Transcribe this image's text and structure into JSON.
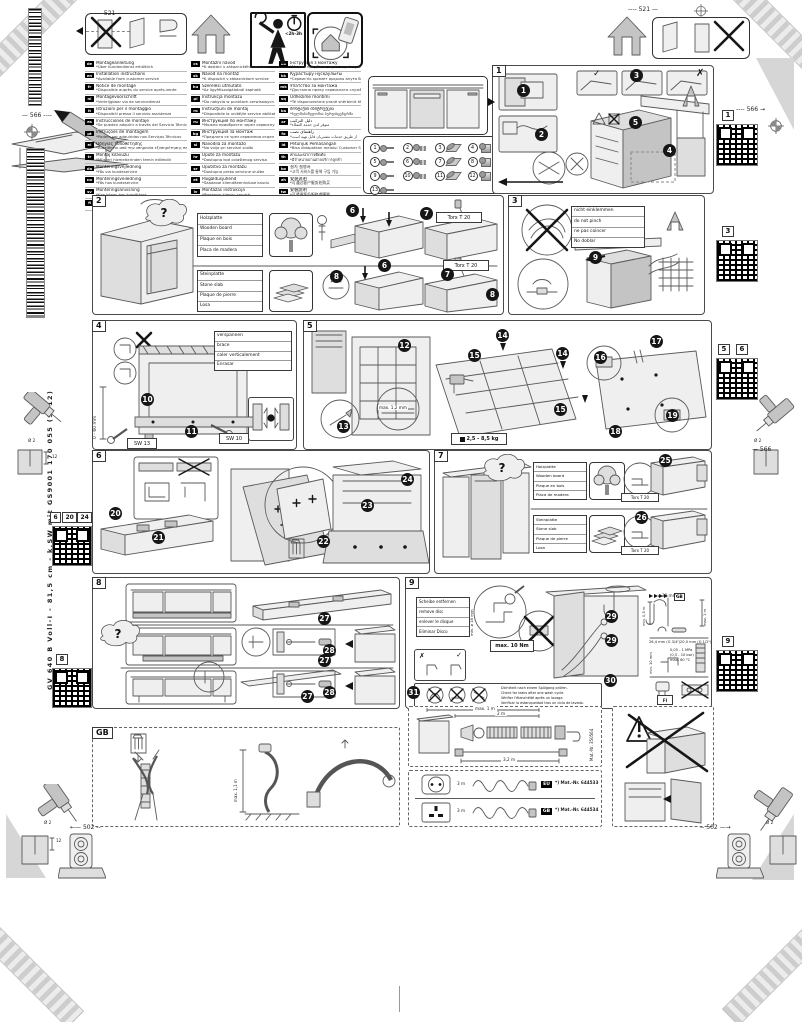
{
  "page": {
    "spine": "GV 640 B Voll-I - 81,5 cm - k.SW mit    GS9001 170 055 (9812)"
  },
  "marks": {
    "check": "✓",
    "cross": "✗",
    "question": "?"
  },
  "badges": {
    "time": "<2h-3h"
  },
  "dims": {
    "w521": "521",
    "w566": "566",
    "w502": "502",
    "drill": "Ø 2",
    "depth": "12"
  },
  "languages": {
    "col1": [
      {
        "code": "de",
        "l1": "Montageanleitung",
        "l2": "*Über Kundendienst erhältlich"
      },
      {
        "code": "en",
        "l1": "Installation instructions",
        "l2": "*Available from customer service"
      },
      {
        "code": "fr",
        "l1": "Notice de montage",
        "l2": "*Disponible auprès du service après-vente"
      },
      {
        "code": "nl",
        "l1": "Montagevoorschrift",
        "l2": "*Verkrijgbaar via de servicedienst"
      },
      {
        "code": "it",
        "l1": "Istruzioni per il montaggio",
        "l2": "*Disponibili presso il servizio assistenza"
      },
      {
        "code": "es",
        "l1": "Instrucciones de montaje",
        "l2": "*Se pueden adquirir a través del Servicio Técnico"
      },
      {
        "code": "pt",
        "l1": "Instruções de montagem",
        "l2": "*Podem ser adquiridas nos Serviços Técnicos"
      },
      {
        "code": "el",
        "l1": "Οδηγίες τοποθέτησης",
        "l2": "*Διατίθεται από την υπηρεσία εξυπηρέτησης πελατών"
      },
      {
        "code": "tr",
        "l1": "Montaj kılavuzu",
        "l2": "*Müşteri hizmetlerinden temin edilebilir"
      },
      {
        "code": "da",
        "l1": "Monteringsvejledning",
        "l2": "*Fås via kundeservice"
      },
      {
        "code": "no",
        "l1": "Monteringsveiledning",
        "l2": "*Fås hos kundeservice"
      },
      {
        "code": "sv",
        "l1": "Monteringsanvisning",
        "l2": "*Kan köpas hos kundtjänst"
      },
      {
        "code": "fi",
        "l1": "Asennusohje",
        "l2": "*Saatavana huoltopalvelusta"
      }
    ],
    "col2": [
      {
        "code": "cs",
        "l1": "Montážní návod",
        "l2": "*K dostání u zákaznického servisu"
      },
      {
        "code": "sk",
        "l1": "Návod na montáž",
        "l2": "*K dispozícii v zákazníckom servise"
      },
      {
        "code": "hu",
        "l1": "Szerelési útmutató",
        "l2": "*Az ügyfélszolgálatnál kapható"
      },
      {
        "code": "pl",
        "l1": "Instrukcja montażu",
        "l2": "*Do nabycia w punktach serwisowych"
      },
      {
        "code": "ro",
        "l1": "Instrucţiuni de montaj",
        "l2": "*Disponibile la unităţile service abilitate"
      },
      {
        "code": "ru",
        "l1": "Инструкция по монтажу",
        "l2": "*Можно приобрести через сервисную службу"
      },
      {
        "code": "bg",
        "l1": "Инструкция за монтаж",
        "l2": "*Предлага се чрез сервизния отдел"
      },
      {
        "code": "sl",
        "l1": "Navodila za montažo",
        "l2": "*Na voljo pri servisni službi"
      },
      {
        "code": "hr",
        "l1": "Upute za montažu",
        "l2": "*Dostupno kod ovlaštenog servisa"
      },
      {
        "code": "sr",
        "l1": "Uputstvo za montažu",
        "l2": "*Dostupno preko servisne službe"
      },
      {
        "code": "et",
        "l1": "Paigaldusjuhend",
        "l2": "*Saadaval klienditeeninduse kaudu"
      },
      {
        "code": "lv",
        "l1": "Montāžas instrukcija",
        "l2": "*Pieejama klientu servisā"
      },
      {
        "code": "lt",
        "l1": "Montavimo instrukcija",
        "l2": "*Galima įsigyti klientų aptarnavimo tarnyboje"
      }
    ],
    "col3": [
      {
        "code": "uk",
        "l1": "Інструкція з монтажу",
        "l2": "*Можна придбати через сервісну службу"
      },
      {
        "code": "kk",
        "l1": "Құрастыру нұсқаулығы",
        "l2": "*Сервистік қызмет арқылы алуға болады"
      },
      {
        "code": "mk",
        "l1": "Упатство за монтажа",
        "l2": "*Достапно преку сервисната служба"
      },
      {
        "code": "sq",
        "l1": "Udhëzime montimi",
        "l2": "*Të disponueshme pranë shërbimit të klientit"
      },
      {
        "code": "ka",
        "l1": "მონტაჟის ინსტრუქცია",
        "l2": "*ხელმისაწვდომია სერვისცენტრში"
      },
      {
        "code": "ar",
        "l1": "دليل التركيب",
        "l2": "*متوفر لدى خدمة العملاء"
      },
      {
        "code": "fa",
        "l1": "راهنمای نصب",
        "l2": "*از طریق خدمات مشتریان قابل تهیه است"
      },
      {
        "code": "id",
        "l1": "Petunjuk Pemasangan",
        "l2": "*Bisa didapatkan melalui Customer Service"
      },
      {
        "code": "th",
        "l1": "คำแนะนำการติดตั้ง",
        "l2": "*มีจำหน่ายผ่านฝ่ายบริการลูกค้า"
      },
      {
        "code": "ko",
        "l1": "설치 설명서",
        "l2": "*고객 서비스를 통해 구입 가능"
      },
      {
        "code": "zh",
        "l1": "安装说明",
        "l2": "*可通过客户服务处购买"
      },
      {
        "code": "tw",
        "l1": "安裝說明",
        "l2": "*可透過客戶服務處購買"
      }
    ]
  },
  "parts": {
    "items": [
      "1",
      "2",
      "3",
      "4",
      "5",
      "6",
      "7",
      "8",
      "9",
      "10",
      "11",
      "12",
      "13"
    ]
  },
  "panels": {
    "p1": {
      "tag": "1",
      "s1": "1",
      "s2": "2",
      "s3": "3",
      "s4": "4",
      "s5": "5"
    },
    "p2": {
      "tag": "2",
      "wood": [
        "Holzplatte",
        "Wooden board",
        "Plaque en bois",
        "Placa de madera"
      ],
      "stone": [
        "Steinplatte",
        "Stone slab",
        "Plaque de pierre",
        "Losa"
      ],
      "torx": "Torx T 20",
      "s6": "6",
      "s7": "7",
      "s8": "8"
    },
    "p3": {
      "tag": "3",
      "note": [
        "nicht einklemmen",
        "do not pinch",
        "ne pas coincer",
        "No doblar"
      ],
      "s9": "9"
    },
    "p4": {
      "tag": "4",
      "note": [
        "verspannen",
        "brace",
        "caler verticalement",
        "Enrasar"
      ],
      "range": "0 - 60 mm",
      "sw13": "SW 13",
      "sw10": "SW 10",
      "s10": "10",
      "s11": "11"
    },
    "p5": {
      "tag": "5",
      "weight": "2,5 - 8,5 kg",
      "gap": "max. 1,2 mm",
      "s12": "12",
      "s13": "13",
      "s14": "14",
      "s15": "15",
      "s16": "16",
      "s17": "17",
      "s18": "18",
      "s19": "19"
    },
    "p6": {
      "tag": "6",
      "s20": "20",
      "s21": "21",
      "s22": "22",
      "s23": "23",
      "s24": "24"
    },
    "p7": {
      "tag": "7",
      "wood": [
        "Holzplatte",
        "Wooden board",
        "Plaque en bois",
        "Placa de madera"
      ],
      "stone": [
        "Steinplatte",
        "Stone slab",
        "Plaque de pierre",
        "Losa"
      ],
      "torx": "Torx T 20",
      "s25": "25",
      "s26": "26"
    },
    "p8": {
      "tag": "8",
      "s27": "27",
      "s28": "28"
    },
    "p9": {
      "tag": "9",
      "disc": [
        "Scheibe entfernen",
        "remove disc",
        "enlever le disque",
        "Eliminar Disco"
      ],
      "disc_dia": "min. ø 18 mm",
      "torque": "max. 10 Nm",
      "s29": "29",
      "s30": "30",
      "s31": "31",
      "check_lines": [
        "Dichtheit nach einem Spülgang prüfen.",
        "Check for leaks after one wash cycle.",
        "Vérifier l'étanchéité après un lavage.",
        "Verificar la estanqueidad tras un ciclo de lavado."
      ],
      "specs": {
        "gb": "GB",
        "hose_dia": "ø 38 mm",
        "min_h": "min. 0,5 m",
        "max_h": "max. 1 m",
        "g34": "26,4 mm (G 3/4\")",
        "g12": "20,0 mm (G 1/2\")",
        "gap": "min. 10 mm",
        "p1": "0,05 - 1 MPa",
        "p2": "(0,5 - 10 bar)",
        "t": "max. 60 °C",
        "fi": "FI"
      }
    },
    "gb": {
      "tag": "GB",
      "hose": "max. 1,1 m"
    },
    "ext": {
      "l1": "max. 1 m",
      "l2": "2 m",
      "l3": "3,2 m",
      "mat": "Mat.-Nr. 350564"
    },
    "cords": {
      "r1": {
        "plug": "EU",
        "len": "3 m",
        "mat": "*) Mat.-Nr. 644533"
      },
      "r2": {
        "plug": "GB",
        "len": "3 m",
        "mat": "*) Mat.-Nr. 644534"
      }
    }
  },
  "qr": {
    "r1": "1",
    "r3": "3",
    "r5": "5",
    "r6": "6",
    "r9": "9",
    "l6a": "6",
    "l6b": "20",
    "l6c": "24",
    "l8": "8"
  }
}
